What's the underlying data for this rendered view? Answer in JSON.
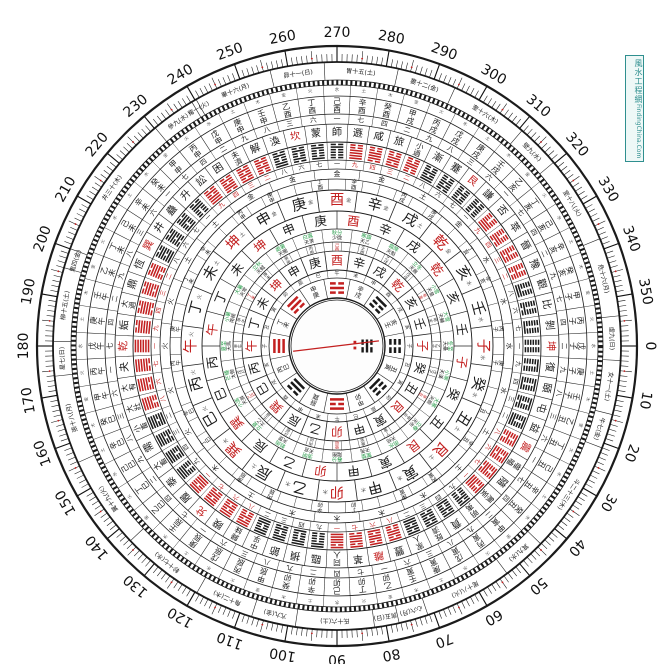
{
  "colors": {
    "red": "#c32020",
    "black": "#1a1a1a",
    "green": "#2e9e4f",
    "teal": "#2f8f8f",
    "gray": "#555555"
  },
  "watermark": {
    "cn": "風水工程網",
    "en": "FindingChina.Com"
  },
  "degree_ring": {
    "labels": [
      0,
      10,
      20,
      30,
      40,
      50,
      60,
      70,
      80,
      90,
      100,
      110,
      120,
      130,
      140,
      150,
      160,
      170,
      180,
      190,
      200,
      210,
      220,
      230,
      240,
      250,
      260,
      270,
      280,
      290,
      300,
      310,
      320,
      330,
      340,
      350
    ]
  },
  "mountains": {
    "names": [
      "子",
      "癸",
      "丑",
      "艮",
      "寅",
      "甲",
      "卯",
      "乙",
      "辰",
      "巽",
      "巳",
      "丙",
      "午",
      "丁",
      "未",
      "坤",
      "申",
      "庚",
      "酉",
      "辛",
      "戌",
      "乾",
      "亥",
      "壬"
    ],
    "red_names": [
      "子",
      "午",
      "卯",
      "酉",
      "乾",
      "坤",
      "艮",
      "巽"
    ],
    "elements": [
      "水",
      "水",
      "土",
      "土",
      "木",
      "木",
      "木",
      "木",
      "土",
      "木",
      "火",
      "火",
      "火",
      "火",
      "土",
      "土",
      "金",
      "金",
      "金",
      "金",
      "土",
      "金",
      "水",
      "水"
    ]
  },
  "heaven_stars": [
    "天壘",
    "天漢",
    "天廚",
    "天市",
    "天棓",
    "天苑",
    "陽衡",
    "天官",
    "天罡",
    "太乙",
    "天屏",
    "太微",
    "天馬",
    "南極",
    "天常",
    "天鉞",
    "天關",
    "天潢",
    "少微",
    "天乙",
    "天魁",
    "天廄",
    "天皇",
    "天輔"
  ],
  "solar_terms": [
    "冬至",
    "小寒",
    "大寒",
    "立春",
    "雨水",
    "驚蟄",
    "春分",
    "清明",
    "穀雨",
    "立夏",
    "小滿",
    "芒種",
    "夏至",
    "小暑",
    "大暑",
    "立秋",
    "處暑",
    "白露",
    "秋分",
    "寒露",
    "霜降",
    "立冬",
    "小雪",
    "大雪"
  ],
  "mansions": {
    "labels": [
      "角十二(木)",
      "亢九(金)",
      "氐十六(土)",
      "房五(日)",
      "心六(月)",
      "尾十八(火)",
      "箕九(水)",
      "斗二十三(木)",
      "牛七(金)",
      "女十一(土)",
      "虛九(日)",
      "危十六(月)",
      "室十八(火)",
      "壁九(水)",
      "奎十六(木)",
      "婁十二(金)",
      "胃十五(土)",
      "昴十一(日)",
      "畢十六(月)",
      "觜一(火)",
      "參九(水)",
      "井三十(木)",
      "鬼四(金)",
      "柳十五(土)",
      "星七(日)",
      "張十八(月)",
      "翼十九(火)",
      "軫十七(水)"
    ],
    "spans": [
      12,
      9,
      16,
      5,
      6,
      18,
      9,
      23,
      7,
      11,
      9,
      16,
      18,
      9,
      16,
      12,
      15,
      11,
      16,
      1,
      9,
      30,
      4,
      15,
      7,
      18,
      19,
      17
    ],
    "anchor_index": 9,
    "anchor_edge_deg": 14
  },
  "hexagrams": {
    "ring_order_from_qian": [
      "乾",
      "姤",
      "大過",
      "鼎",
      "恆",
      "巽",
      "井",
      "蠱",
      "升",
      "訟",
      "困",
      "未濟",
      "解",
      "渙",
      "坎",
      "蒙",
      "師",
      "遯",
      "咸",
      "旅",
      "小過",
      "漸",
      "蹇",
      "艮",
      "謙",
      "否",
      "萃",
      "晉",
      "豫",
      "觀",
      "比",
      "剝",
      "坤",
      "復",
      "頤",
      "屯",
      "益",
      "震",
      "噬嗑",
      "隨",
      "無妄",
      "明夷",
      "賁",
      "既濟",
      "家人",
      "豐",
      "離",
      "革",
      "同人",
      "臨",
      "損",
      "節",
      "中孚",
      "歸妹",
      "睽",
      "兌",
      "履",
      "泰",
      "大畜",
      "需",
      "小畜",
      "大壯",
      "大有",
      "夬"
    ],
    "red_names": [
      "乾",
      "坤",
      "坎",
      "離",
      "震",
      "巽",
      "艮",
      "兌"
    ]
  },
  "jiazi": {
    "stems_even": [
      "甲",
      "丙",
      "戊",
      "庚",
      "壬"
    ],
    "stems_odd": [
      "乙",
      "丁",
      "己",
      "辛",
      "癸"
    ],
    "stems10": [
      "甲",
      "乙",
      "丙",
      "丁",
      "戊",
      "己",
      "庚",
      "辛",
      "壬",
      "癸"
    ],
    "branches": [
      "子",
      "丑",
      "寅",
      "卯",
      "辰",
      "巳",
      "午",
      "未",
      "申",
      "酉",
      "戌",
      "亥"
    ]
  },
  "number_cycles": {
    "outer60": [
      "七",
      "四",
      "二",
      "九",
      "八",
      "三",
      "六",
      "一"
    ],
    "inner64": [
      "一",
      "九",
      "四",
      "三",
      "二",
      "八",
      "六",
      "七"
    ],
    "nayin": [
      "金",
      "火",
      "水",
      "土",
      "木"
    ]
  },
  "bagua": {
    "placement_fuxi": [
      {
        "dir": 0,
        "name": "坤",
        "code": "000",
        "red": false
      },
      {
        "dir": 45,
        "name": "震",
        "code": "100",
        "red": false
      },
      {
        "dir": 90,
        "name": "離",
        "code": "101",
        "red": true
      },
      {
        "dir": 135,
        "name": "兌",
        "code": "110",
        "red": false
      },
      {
        "dir": 180,
        "name": "乾",
        "code": "111",
        "red": true
      },
      {
        "dir": 225,
        "name": "巽",
        "code": "011",
        "red": true
      },
      {
        "dir": 270,
        "name": "坎",
        "code": "010",
        "red": true
      },
      {
        "dir": 315,
        "name": "艮",
        "code": "001",
        "red": false
      }
    ],
    "branch_pairs": [
      "丑寅",
      "甲卯",
      "辰巽",
      "丙巳",
      "丁未",
      "申庚",
      "辛戌",
      "亥壬"
    ]
  },
  "center_pool": {
    "north_marker_code": "010",
    "needle_tilt_deg": -3.5
  }
}
